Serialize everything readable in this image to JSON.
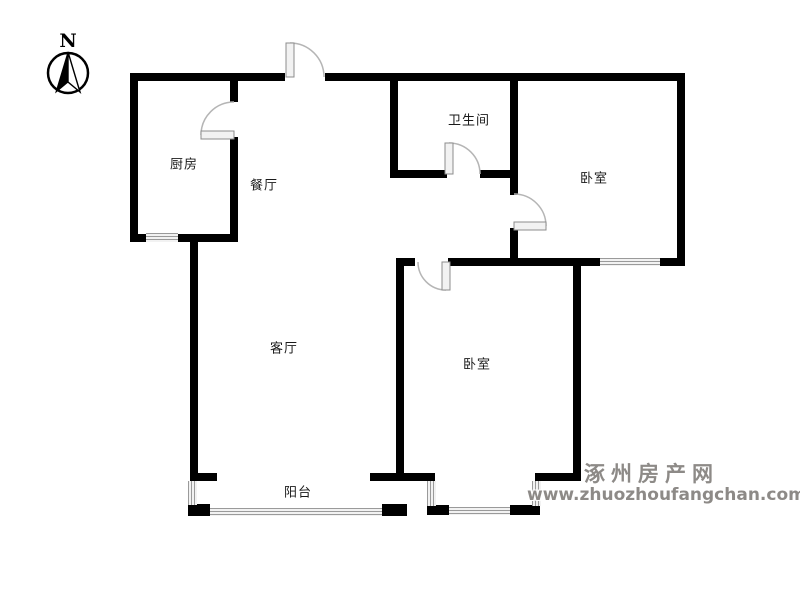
{
  "compass": {
    "label": "N"
  },
  "rooms": {
    "kitchen": {
      "label": "厨房"
    },
    "dining": {
      "label": "餐厅"
    },
    "bathroom": {
      "label": "卫生间"
    },
    "bedroom_top": {
      "label": "卧室"
    },
    "bedroom_bottom": {
      "label": "卧室"
    },
    "living": {
      "label": "客厅"
    },
    "balcony": {
      "label": "阳台"
    }
  },
  "watermark": {
    "site_name": "涿州房产网",
    "url": "www.zhuozhoufangchan.com"
  },
  "colors": {
    "wall": "#000000",
    "window_line": "#9a9a9a",
    "door_line": "#b5b5b5",
    "watermark": "#8d8a87",
    "background": "#ffffff"
  }
}
